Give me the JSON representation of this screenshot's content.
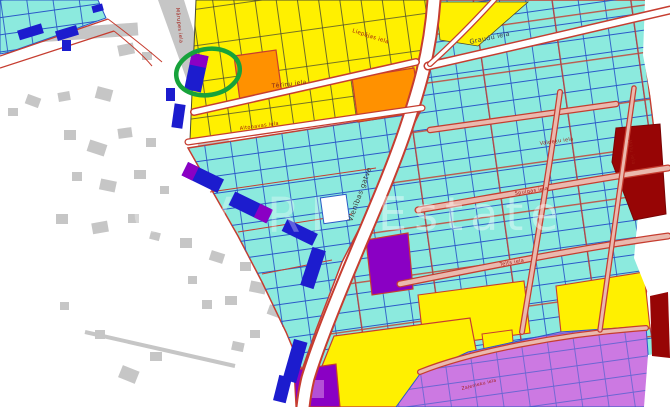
{
  "map": {
    "watermark_left": "CiV RI",
    "watermark_right": "Estate",
    "streets": {
      "vienibas": "Vienības gatve",
      "terinu": "Tēriņu iela",
      "altonavas": "Altonavas iela",
      "liepajas": "Liepājas iela",
      "marupes": "Mārupes iela",
      "graudu": "Graudu iela",
      "valdeku": "Valdeķu iela",
      "spulgas": "Spulgas iela",
      "telts": "Telts iela",
      "malu": "Mālu iela",
      "zalenieku": "Zaļenieku iela"
    },
    "annotation": {
      "shape": "ellipse",
      "purpose": "highlighted-parcel"
    },
    "palette": {
      "parcel_cyan": "#8ceade",
      "parcel_yellow": "#fff000",
      "parcel_orange": "#ff9100",
      "parcel_purple": "#8a00c4",
      "parcel_magenta": "#cc79e2",
      "parcel_magenta_light": "#b44fd6",
      "parcel_darkred": "#970505",
      "building_blue": "#1c1cce",
      "building_gray": "#c6c6c6",
      "boundary_red": "#c63d30",
      "parcel_line_blue": "#2b59c8",
      "road_pink": "#eab9ae",
      "annotation_green": "#17a23b"
    }
  }
}
